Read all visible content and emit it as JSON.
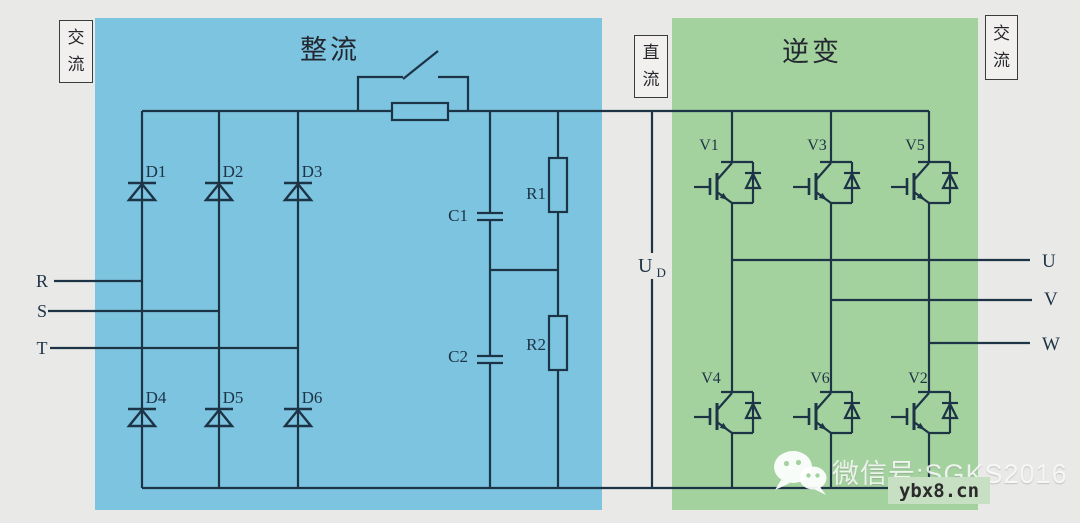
{
  "diagram": {
    "sections": {
      "rectifier_title": "整流",
      "inverter_title": "逆变",
      "ac_input_badge": "交\n流",
      "dc_link_badge": "直\n流",
      "ac_output_badge": "交\n流"
    },
    "components": {
      "rectifier_diodes_top": [
        "D1",
        "D2",
        "D3"
      ],
      "rectifier_diodes_bottom": [
        "D4",
        "D5",
        "D6"
      ],
      "inverter_igbts_top": [
        "V1",
        "V3",
        "V5"
      ],
      "inverter_igbts_bottom": [
        "V4",
        "V6",
        "V2"
      ],
      "capacitors": [
        "C1",
        "C2"
      ],
      "resistors": [
        "R1",
        "R2"
      ]
    },
    "terminals": {
      "inputs": [
        "R",
        "S",
        "T"
      ],
      "outputs": [
        "U",
        "V",
        "W"
      ],
      "dc_voltage_base": "U",
      "dc_voltage_sub": "D"
    }
  },
  "watermark": {
    "wechat_text": "微信号:SGKS2016",
    "site_text": "ybx8.cn"
  },
  "colors": {
    "canvas_bg": "#e9e9e7",
    "rectifier_bg": "#7cc4e0",
    "inverter_bg": "#a4d29f",
    "line": "#1d3346",
    "badge_bg": "#f1f0ee",
    "watermark_text": "rgba(255,255,255,0.82)",
    "site_highlight_bg": "#c7dfc3"
  }
}
